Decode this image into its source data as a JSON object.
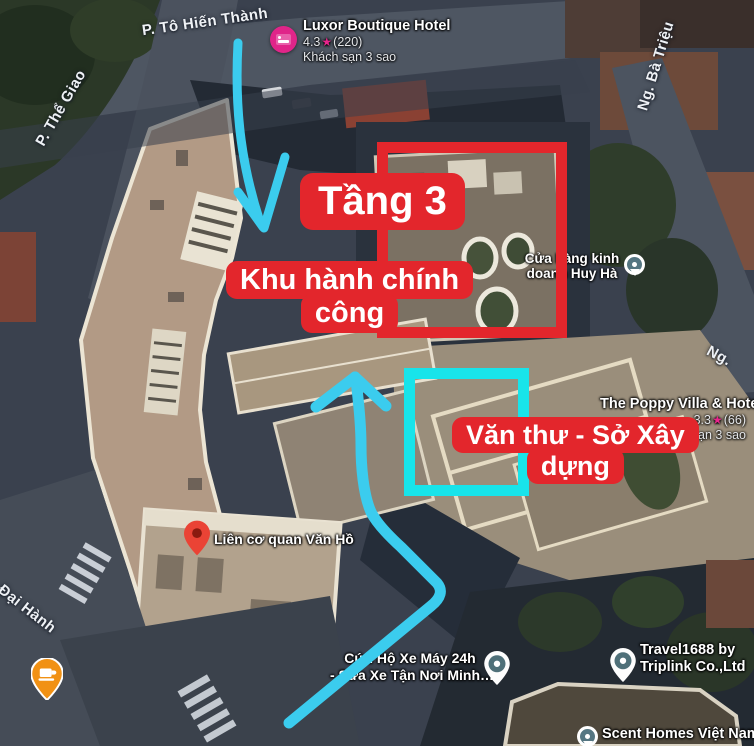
{
  "annotations": {
    "floor_label": "Tầng 3",
    "admin_label": {
      "line1": "Khu hành chính",
      "line2": "công"
    },
    "vanthu_label": {
      "line1": "Văn thư - Sở Xây",
      "line2": "dựng"
    },
    "colors": {
      "red": "#e3262c",
      "cyan": "#18e4ea",
      "arrow": "#3bccee"
    }
  },
  "streets": {
    "to_hien_thanh": "P. Tô Hiến Thành",
    "the_giao": "P. Thể Giao",
    "ba_trieu": "Ng. Bà Triệu",
    "ng_partial": "Ng.",
    "dai_hanh": "Đại Hành"
  },
  "places": {
    "luxor": {
      "name": "Luxor Boutique Hotel",
      "rating": "4.3",
      "star": "★",
      "reviews": "(220)",
      "category": "Khách sạn 3 sao"
    },
    "huy_ha": {
      "line1": "Cửa hàng kinh",
      "line2": "doanh Huy Hà"
    },
    "poppy": {
      "name": "The Poppy Villa & Hotel",
      "rating": "3.3",
      "star": "★",
      "reviews": "(66)",
      "category": "Khách sạn 3 sao"
    },
    "lien_co_quan": {
      "name": "Liên cơ quan Văn Hồ"
    },
    "cuu_ho": {
      "line1": "Cứu Hộ Xe Máy 24h",
      "line2": "- Sửa Xe Tận Nơi Minh…"
    },
    "travel1688": {
      "line1": "Travel1688 by",
      "line2": "Triplink Co.,Ltd"
    },
    "scent_homes": {
      "name": "Scent Homes Việt Nam"
    }
  }
}
